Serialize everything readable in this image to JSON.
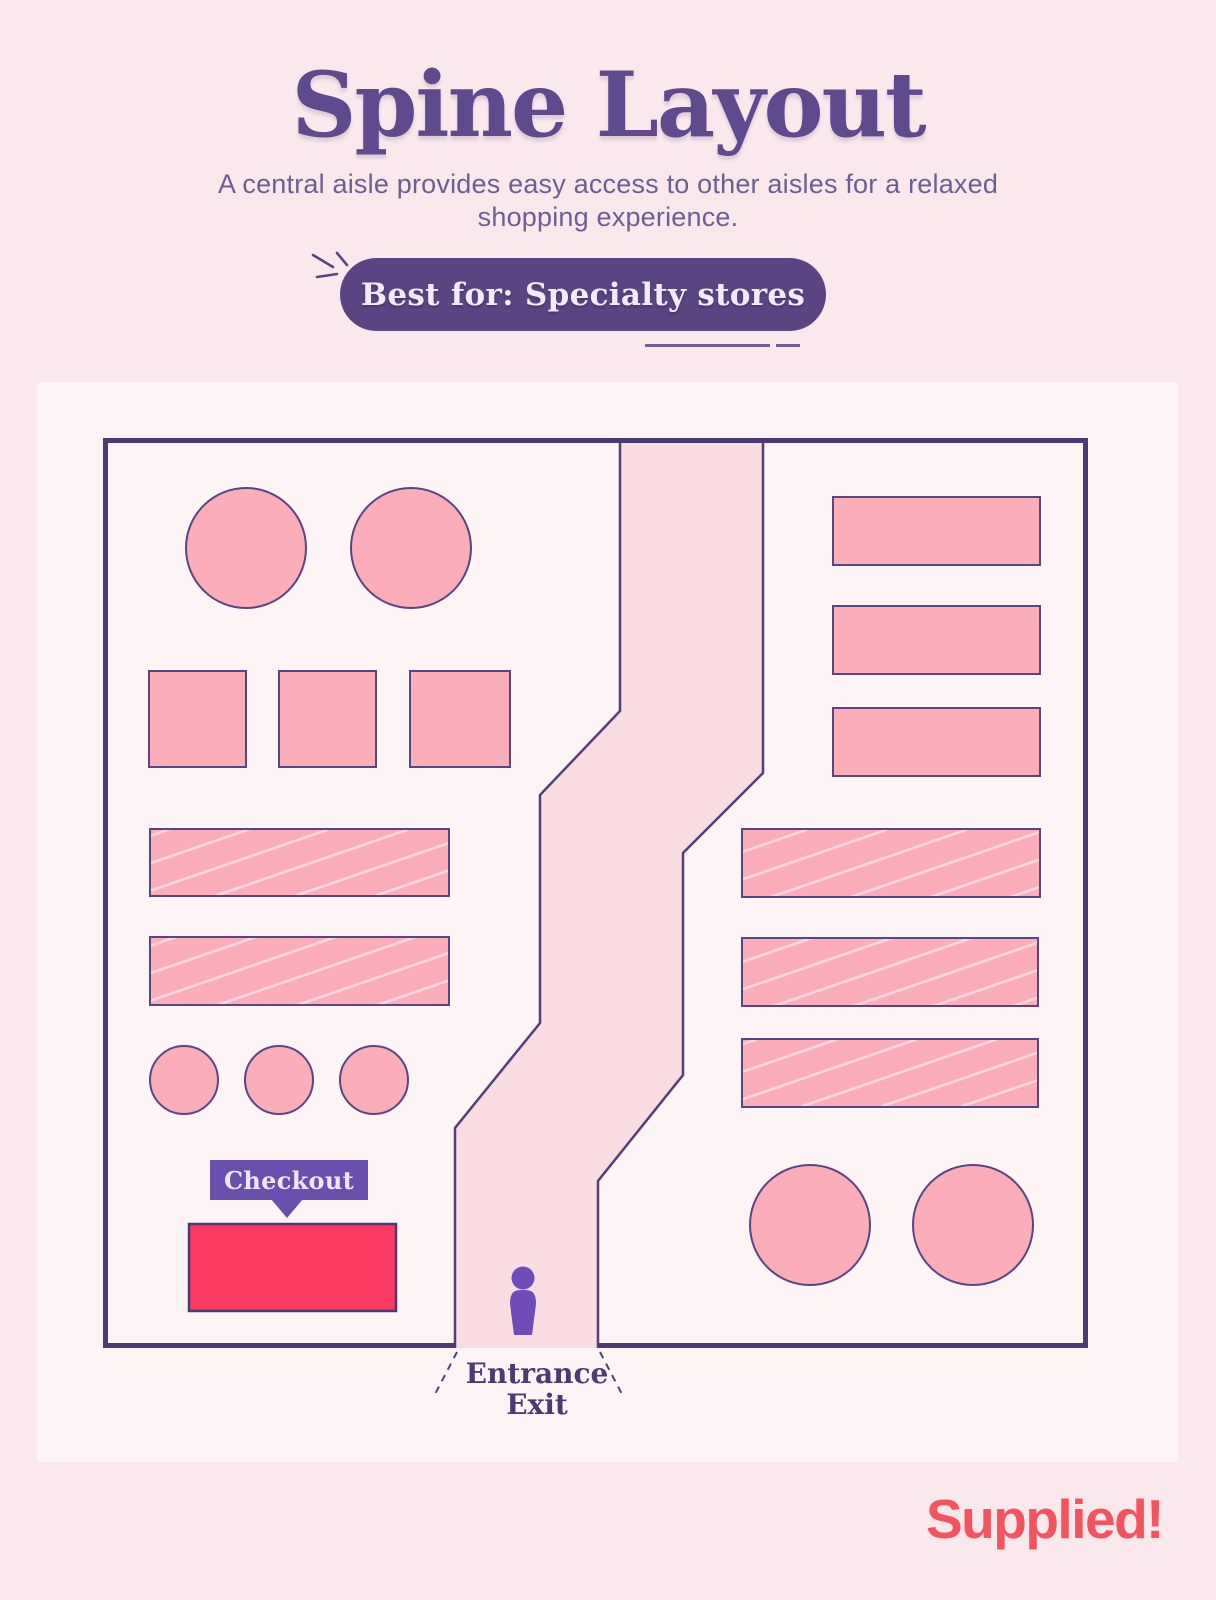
{
  "page": {
    "title": "Spine Layout",
    "subtitle_line1": "A central aisle provides easy access to other aisles for a relaxed",
    "subtitle_line2": "shopping experience.",
    "badge": "Best for: Specialty stores",
    "brand": "Supplied!"
  },
  "floor_plan": {
    "checkout_label": "Checkout",
    "entrance_label_line1": "Entrance",
    "entrance_label_line2": "Exit",
    "legend": {
      "left_zone_shapes": "2 large round tables, 3 square tables, 2 hatched shelf rows, 3 small round displays, 1 red checkout counter",
      "center_zone_shapes": "winding spine aisle with shopper figure at entrance/exit",
      "right_zone_shapes": "3 plain shelf rows, 3 hatched shelf rows, 2 large round tables"
    }
  },
  "colors": {
    "page_background": "#fbe8ed",
    "card_background": "#fdf4f6",
    "outline_purple": "#4c3a72",
    "shape_pink": "#fbadb9",
    "aisle_pink": "#fadce3",
    "checkout_red": "#fa3a62",
    "checkout_label_purple": "#6a4fae",
    "badge_purple": "#5b4482",
    "title_purple": "#5e4a8c",
    "person_purple": "#6f4cba",
    "logo_red": "#f4545f"
  }
}
